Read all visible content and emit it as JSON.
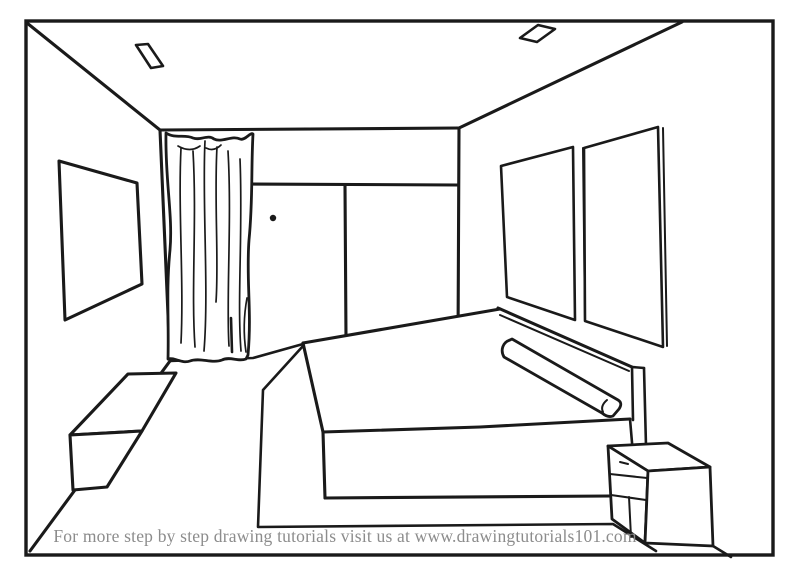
{
  "footer": {
    "text": "For more step by step drawing tutorials visit us at www.drawingtutorials101.com"
  },
  "colors": {
    "background": "#ffffff",
    "line": "#1a1a1a",
    "footer_text": "#8c8c8c"
  },
  "drawing": {
    "title_semantic": "one-point-perspective-bedroom-line-drawing",
    "objects": [
      "room-border",
      "ceiling-light",
      "ceiling-light",
      "picture-frame",
      "curtain",
      "sliding-door",
      "door-knob",
      "double-window",
      "bed-headboard",
      "bed-mattress",
      "bolster-pillow",
      "rug",
      "storage-bench",
      "nightstand"
    ]
  }
}
